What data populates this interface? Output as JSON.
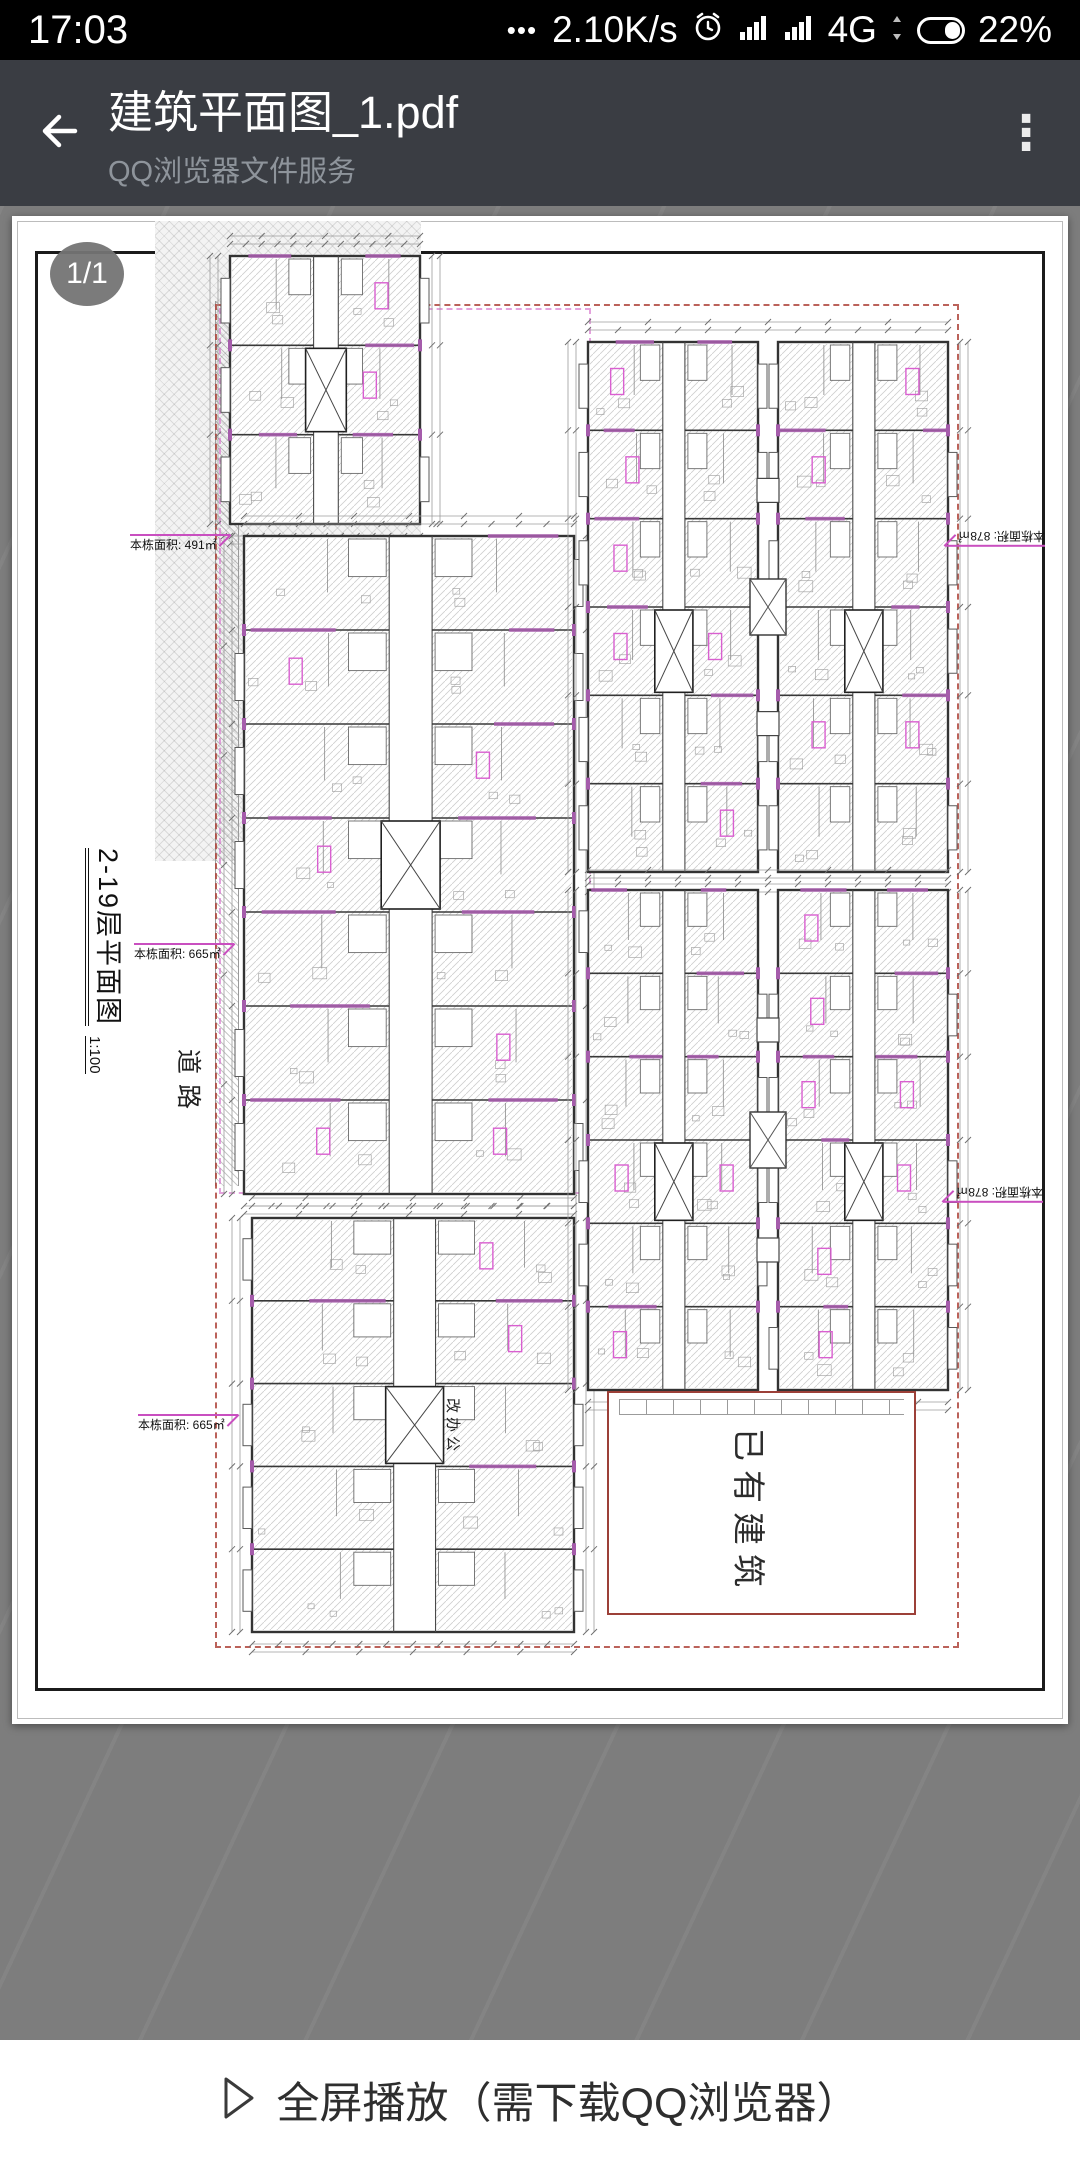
{
  "status_bar": {
    "time": "17:03",
    "notification_dots": "•••",
    "net_speed": "2.10K/s",
    "network_type": "4G",
    "battery_percent": "22%"
  },
  "header": {
    "title": "建筑平面图_1.pdf",
    "subtitle": "QQ浏览器文件服务",
    "menu_icon": "⋮"
  },
  "viewer": {
    "page_badge": "1/1"
  },
  "plan": {
    "title": "2-19层平面图",
    "scale": "1:100",
    "road": "道路",
    "existing_building": "已有建筑",
    "renovation_note": "改办公",
    "area_labels": [
      {
        "id": "left-top",
        "text": "本栋面积: 491㎡"
      },
      {
        "id": "left-middle",
        "text": "本栋面积: 665㎡"
      },
      {
        "id": "left-bottom",
        "text": "本栋面积: 665㎡"
      },
      {
        "id": "right-top",
        "text": "本栋面积: 878㎡"
      },
      {
        "id": "right-bottom",
        "text": "本栋面积: 878㎡"
      }
    ],
    "colors": {
      "accent_purple": "#a55cab",
      "label_pink": "#d95fd0",
      "boundary_red": "#b5443c",
      "wall": "#333333",
      "hatch": "#c6c6c6"
    },
    "blocks": [
      {
        "name": "left-top",
        "x": 218,
        "y": 40,
        "w": 190,
        "h": 268,
        "rows": 3,
        "type": "slab",
        "seed": 11
      },
      {
        "name": "left-middle",
        "x": 232,
        "y": 320,
        "w": 330,
        "h": 658,
        "rows": 7,
        "type": "slab",
        "seed": 22
      },
      {
        "name": "left-bottom",
        "x": 240,
        "y": 1002,
        "w": 322,
        "h": 414,
        "rows": 5,
        "type": "slab",
        "seed": 33
      },
      {
        "name": "right-top",
        "x": 576,
        "y": 126,
        "w": 360,
        "h": 530,
        "rows": 6,
        "type": "twin",
        "seed": 44
      },
      {
        "name": "right-bottom",
        "x": 576,
        "y": 674,
        "w": 360,
        "h": 500,
        "rows": 6,
        "type": "twin",
        "seed": 55
      }
    ]
  },
  "bottom_bar": {
    "label": "全屏播放（需下载QQ浏览器）"
  }
}
